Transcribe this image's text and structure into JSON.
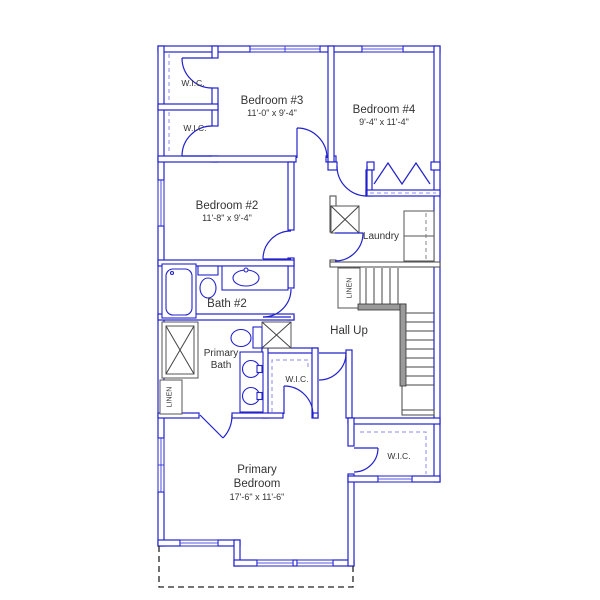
{
  "plan": {
    "title": "Second floor plan",
    "colors": {
      "wall_blue": "#2222cc",
      "detail_gray": "#555555",
      "stair_hatch_fill": "#9a9a9a",
      "text_color": "#333333",
      "roof_dash": "#222222",
      "background": "#ffffff"
    },
    "rooms": {
      "wic_top1": {
        "label": "W.I.C."
      },
      "wic_top2": {
        "label": "W.I.C."
      },
      "bedroom3": {
        "name": "Bedroom #3",
        "dims": "11'-0\" x 9'-4\""
      },
      "bedroom4": {
        "name": "Bedroom #4",
        "dims": "9'-4\" x 11'-4\""
      },
      "bedroom2": {
        "name": "Bedroom #2",
        "dims": "11'-8\" x 9'-4\""
      },
      "laundry": {
        "name": "Laundry"
      },
      "bath2": {
        "name": "Bath #2"
      },
      "hall": {
        "name": "Hall Up"
      },
      "primary_bath": {
        "line1": "Primary",
        "line2": "Bath"
      },
      "linen_hall": {
        "label": "LINEN"
      },
      "linen_bath": {
        "label": "LINEN"
      },
      "wic_mid": {
        "label": "W.I.C."
      },
      "wic_bottom_right": {
        "label": "W.I.C."
      },
      "primary_bedroom": {
        "line1": "Primary",
        "line2": "Bedroom",
        "dims": "17'-6\" x 11'-6\""
      }
    }
  }
}
